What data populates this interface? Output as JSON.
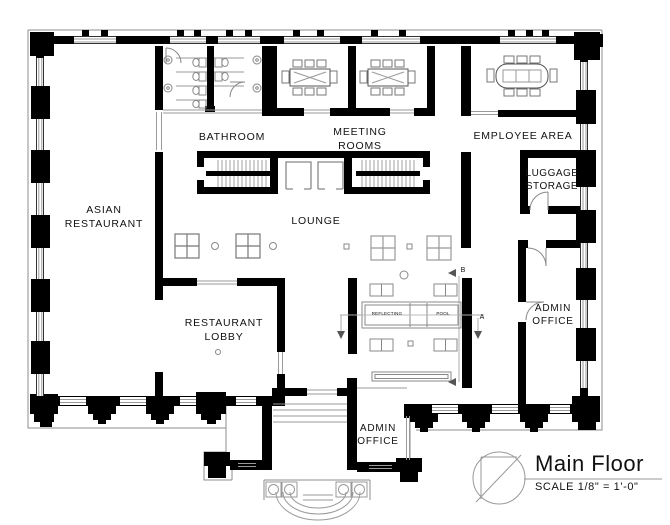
{
  "drawing": {
    "title": "Main Floor",
    "scale_note": "SCALE 1/8\" = 1'-0\""
  },
  "rooms": [
    {
      "id": "asian-restaurant",
      "label_lines": [
        "ASIAN",
        "RESTAURANT"
      ]
    },
    {
      "id": "bathroom",
      "label_lines": [
        "BATHROOM"
      ]
    },
    {
      "id": "meeting-rooms",
      "label_lines": [
        "MEETING",
        "ROOMS"
      ]
    },
    {
      "id": "employee-area",
      "label_lines": [
        "EMPLOYEE AREA"
      ]
    },
    {
      "id": "luggage-storage",
      "label_lines": [
        "LUGGAGE",
        "STORAGE"
      ]
    },
    {
      "id": "lounge",
      "label_lines": [
        "LOUNGE"
      ]
    },
    {
      "id": "restaurant-lobby",
      "label_lines": [
        "RESTAURANT",
        "LOBBY"
      ]
    },
    {
      "id": "admin-office-east",
      "label_lines": [
        "ADMIN",
        "OFFICE"
      ]
    },
    {
      "id": "admin-office-south",
      "label_lines": [
        "ADMIN",
        "OFFICE"
      ]
    }
  ],
  "features": {
    "pool_label_left": "REFLECTING",
    "pool_label_right": "POOL"
  },
  "section_markers": {
    "a": "A",
    "b": "B"
  },
  "colors": {
    "wall": "#000000",
    "thin_line": "#8c8c8c",
    "window_line": "#9a9a9a",
    "furniture_line": "#777777",
    "text": "#111111",
    "background": "#ffffff"
  }
}
